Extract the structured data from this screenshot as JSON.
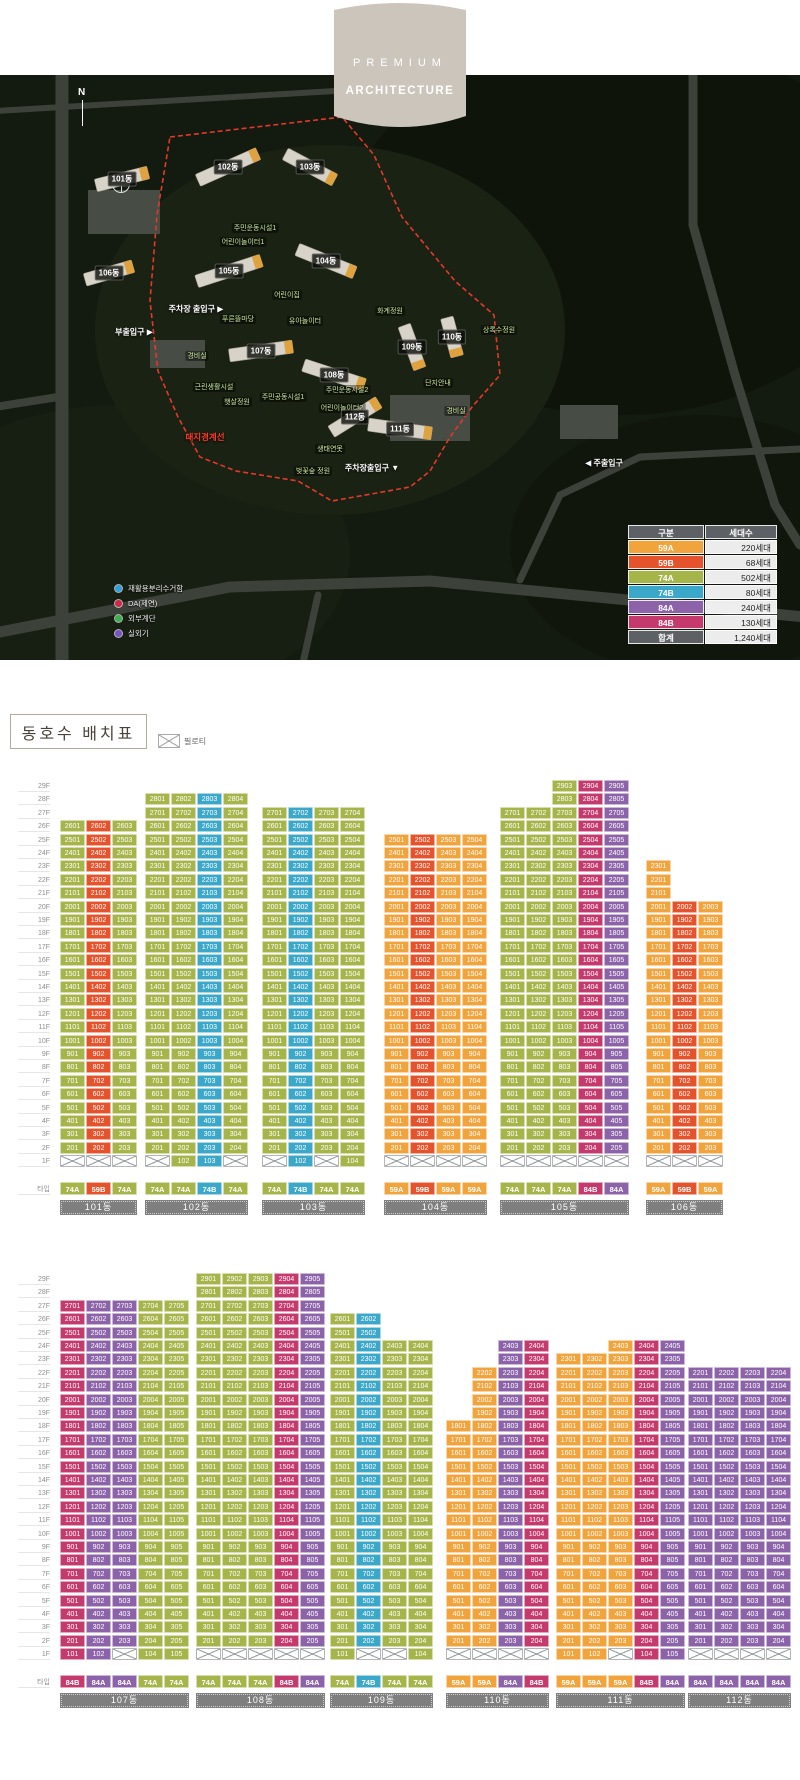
{
  "banner": {
    "line1": "PREMIUM",
    "line2": "ARCHITECTURE"
  },
  "layout": {
    "title": "동호수 배치표",
    "piloti_label": "필로티",
    "type_row_label": "타입"
  },
  "type_colors": {
    "59A": "#F1A33C",
    "59B": "#E4532C",
    "74A": "#A6B54A",
    "74B": "#3BA7C9",
    "84A": "#8C63A9",
    "84B": "#C43A6D"
  },
  "floor_labels": [
    "29F",
    "28F",
    "27F",
    "26F",
    "25F",
    "24F",
    "23F",
    "22F",
    "21F",
    "20F",
    "19F",
    "18F",
    "17F",
    "16F",
    "15F",
    "14F",
    "13F",
    "12F",
    "11F",
    "10F",
    "9F",
    "8F",
    "7F",
    "6F",
    "5F",
    "4F",
    "3F",
    "2F",
    "1F"
  ],
  "map": {
    "north_label": "N",
    "boundary_label": "대지경계선",
    "legend_table": {
      "headers": [
        "구분",
        "세대수"
      ],
      "rows": [
        {
          "type": "59A",
          "count": "220세대"
        },
        {
          "type": "59B",
          "count": "68세대"
        },
        {
          "type": "74A",
          "count": "502세대"
        },
        {
          "type": "74B",
          "count": "80세대"
        },
        {
          "type": "84A",
          "count": "240세대"
        },
        {
          "type": "84B",
          "count": "130세대"
        }
      ],
      "total": {
        "label": "합계",
        "count": "1,240세대"
      }
    },
    "marker_legend": [
      {
        "label": "재활용분리수거함",
        "color": "#2f9fe0"
      },
      {
        "label": "DA(제연)",
        "color": "#d1254a"
      },
      {
        "label": "외부계단",
        "color": "#3bb04d"
      },
      {
        "label": "실외기",
        "color": "#7a52c7"
      }
    ],
    "buildings": [
      {
        "label": "101동",
        "x": 122,
        "y": 104,
        "w": 54,
        "angle": -14
      },
      {
        "label": "102동",
        "x": 228,
        "y": 92,
        "w": 66,
        "angle": -24
      },
      {
        "label": "103동",
        "x": 310,
        "y": 92,
        "w": 56,
        "angle": 28
      },
      {
        "label": "104동",
        "x": 326,
        "y": 186,
        "w": 62,
        "angle": 22
      },
      {
        "label": "105동",
        "x": 229,
        "y": 196,
        "w": 68,
        "angle": -18
      },
      {
        "label": "106동",
        "x": 109,
        "y": 198,
        "w": 50,
        "angle": -16
      },
      {
        "label": "107동",
        "x": 261,
        "y": 276,
        "w": 64,
        "angle": -8
      },
      {
        "label": "108동",
        "x": 334,
        "y": 300,
        "w": 64,
        "angle": 18
      },
      {
        "label": "109동",
        "x": 412,
        "y": 272,
        "w": 46,
        "angle": 70
      },
      {
        "label": "110동",
        "x": 452,
        "y": 262,
        "w": 40,
        "angle": 75
      },
      {
        "label": "111동",
        "x": 400,
        "y": 354,
        "w": 64,
        "angle": 8
      },
      {
        "label": "112동",
        "x": 355,
        "y": 342,
        "w": 56,
        "angle": -32
      }
    ],
    "facilities": [
      {
        "label": "주민운동시설1",
        "x": 255,
        "y": 153
      },
      {
        "label": "어린이놀이터1",
        "x": 243,
        "y": 167
      },
      {
        "label": "어린이집",
        "x": 287,
        "y": 220
      },
      {
        "label": "유아놀이터",
        "x": 305,
        "y": 246
      },
      {
        "label": "푸른뜰마당",
        "x": 238,
        "y": 244
      },
      {
        "label": "화계정원",
        "x": 390,
        "y": 236
      },
      {
        "label": "경비실",
        "x": 197,
        "y": 281
      },
      {
        "label": "근린생활시설",
        "x": 214,
        "y": 312
      },
      {
        "label": "햇살정원",
        "x": 237,
        "y": 327
      },
      {
        "label": "주민공동시설1",
        "x": 283,
        "y": 322
      },
      {
        "label": "주민운동시설2",
        "x": 347,
        "y": 315
      },
      {
        "label": "어린이놀이터2",
        "x": 342,
        "y": 333
      },
      {
        "label": "생태연못",
        "x": 330,
        "y": 374
      },
      {
        "label": "벚꽃숲 정원",
        "x": 313,
        "y": 396
      },
      {
        "label": "단지안내",
        "x": 438,
        "y": 308
      },
      {
        "label": "경비실",
        "x": 456,
        "y": 336
      },
      {
        "label": "상록수정원",
        "x": 499,
        "y": 255
      }
    ],
    "entrances": [
      {
        "label": "주차장 출입구 ▶",
        "x": 196,
        "y": 234
      },
      {
        "label": "부출입구 ▶",
        "x": 134,
        "y": 257
      },
      {
        "label": "◀ 주출입구",
        "x": 604,
        "y": 388
      },
      {
        "label": "주차장출입구 ▼",
        "x": 372,
        "y": 393
      }
    ]
  },
  "sections": [
    {
      "buildings": [
        {
          "name": "101동",
          "x": 60,
          "columns": [
            {
              "type": "74A",
              "top": 26,
              "ground": "X"
            },
            {
              "type": "59B",
              "top": 26,
              "ground": "X"
            },
            {
              "type": "74A",
              "top": 26,
              "ground": "X"
            }
          ]
        },
        {
          "name": "102동",
          "x": 145,
          "columns": [
            {
              "type": "74A",
              "top": 28,
              "ground": "X"
            },
            {
              "type": "74A",
              "top": 28,
              "ground": "102"
            },
            {
              "type": "74B",
              "top": 28,
              "ground": "103"
            },
            {
              "type": "74A",
              "top": 28,
              "ground": "X"
            }
          ]
        },
        {
          "name": "103동",
          "x": 262,
          "columns": [
            {
              "type": "74A",
              "top": 27,
              "ground": "X"
            },
            {
              "type": "74B",
              "top": 27,
              "ground": "102"
            },
            {
              "type": "74A",
              "top": 27,
              "ground": "X"
            },
            {
              "type": "74A",
              "top": 27,
              "ground": "104"
            }
          ]
        },
        {
          "name": "104동",
          "x": 384,
          "columns": [
            {
              "type": "59A",
              "top": 25,
              "ground": "X"
            },
            {
              "type": "59B",
              "top": 25,
              "ground": "X"
            },
            {
              "type": "59A",
              "top": 25,
              "ground": "X"
            },
            {
              "type": "59A",
              "top": 25,
              "ground": "X"
            }
          ]
        },
        {
          "name": "105동",
          "x": 500,
          "columns": [
            {
              "type": "74A",
              "top": 27,
              "ground": "X"
            },
            {
              "type": "74A",
              "top": 27,
              "ground": "X"
            },
            {
              "type": "74A",
              "top": 29,
              "ground": "X"
            },
            {
              "type": "84B",
              "top": 29,
              "ground": "X"
            },
            {
              "type": "84A",
              "top": 29,
              "ground": "X"
            }
          ]
        },
        {
          "name": "106동",
          "x": 646,
          "columns": [
            {
              "type": "59A",
              "top": 23,
              "ground": "X"
            },
            {
              "type": "59B",
              "top": 20,
              "ground": "X"
            },
            {
              "type": "59A",
              "top": 20,
              "ground": "X"
            }
          ]
        }
      ]
    },
    {
      "buildings": [
        {
          "name": "107동",
          "x": 60,
          "columns": [
            {
              "type": "84B",
              "top": 27,
              "ground": "101"
            },
            {
              "type": "84A",
              "top": 27,
              "ground": "102"
            },
            {
              "type": "84A",
              "top": 27,
              "ground": "X"
            },
            {
              "type": "74A",
              "top": 27,
              "ground": "104"
            },
            {
              "type": "74A",
              "top": 27,
              "ground": "105"
            }
          ]
        },
        {
          "name": "108동",
          "x": 196,
          "columns": [
            {
              "type": "74A",
              "top": 29,
              "ground": "X"
            },
            {
              "type": "74A",
              "top": 29,
              "ground": "X"
            },
            {
              "type": "74A",
              "top": 29,
              "ground": "X"
            },
            {
              "type": "84B",
              "top": 29,
              "ground": "X"
            },
            {
              "type": "84A",
              "top": 29,
              "ground": "X"
            }
          ]
        },
        {
          "name": "109동",
          "x": 330,
          "columns": [
            {
              "type": "74A",
              "top": 26,
              "ground": "101"
            },
            {
              "type": "74B",
              "top": 26,
              "ground": "X"
            },
            {
              "type": "74A",
              "top": 24,
              "ground": "X"
            },
            {
              "type": "74A",
              "top": 24,
              "ground": "104"
            }
          ]
        },
        {
          "name": "110동",
          "x": 446,
          "columns": [
            {
              "type": "59A",
              "top": 18,
              "ground": "X"
            },
            {
              "type": "59A",
              "top": 22,
              "ground": "X"
            },
            {
              "type": "84A",
              "top": 24,
              "ground": "X"
            },
            {
              "type": "84B",
              "top": 24,
              "ground": "X"
            }
          ]
        },
        {
          "name": "111동",
          "x": 556,
          "columns": [
            {
              "type": "59A",
              "top": 23,
              "ground": "101"
            },
            {
              "type": "59A",
              "top": 23,
              "ground": "102"
            },
            {
              "type": "59A",
              "top": 24,
              "ground": "X"
            },
            {
              "type": "84B",
              "top": 24,
              "ground": "104"
            },
            {
              "type": "84A",
              "top": 24,
              "ground": "105"
            }
          ]
        },
        {
          "name": "112동",
          "x": 688,
          "columns": [
            {
              "type": "84A",
              "top": 22,
              "ground": "X"
            },
            {
              "type": "84A",
              "top": 22,
              "ground": "X"
            },
            {
              "type": "84A",
              "top": 22,
              "ground": "X"
            },
            {
              "type": "84A",
              "top": 22,
              "ground": "X"
            }
          ]
        }
      ]
    }
  ]
}
